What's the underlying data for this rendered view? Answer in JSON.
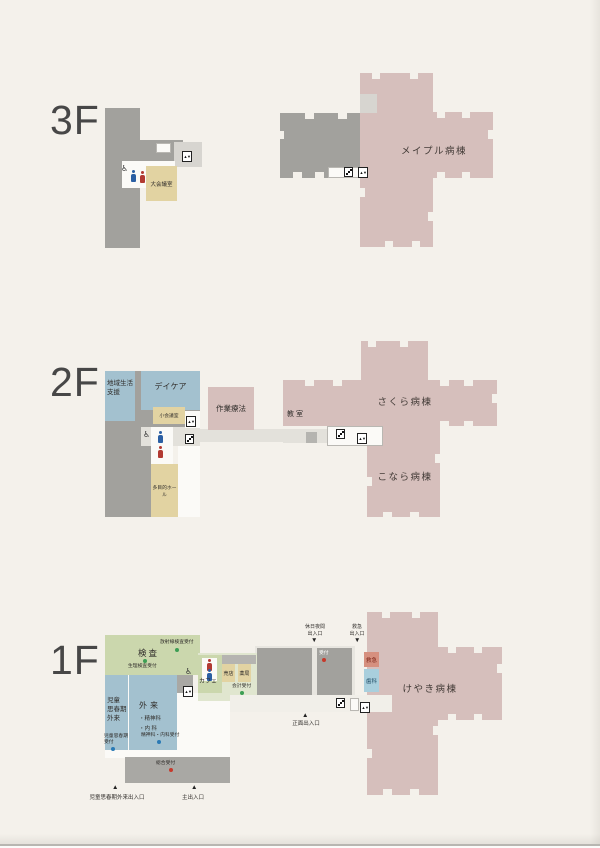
{
  "colors": {
    "background": "#f4f1eb",
    "building_gray": "#a2a19d",
    "building_gray_light": "#d7d5d0",
    "corridor_gray": "#e3e1db",
    "white_room": "#fbfaf7",
    "ward_pink": "#d6bfbc",
    "room_blue": "#a3c1cf",
    "room_green": "#cbd7ad",
    "room_green_pale": "#e0e6cf",
    "room_tan": "#e2d3a2",
    "emergency_salmon": "#d6907f",
    "dental_blue": "#a9cfdd",
    "plaza_gray": "#e8e6e0",
    "text_dark": "#322f2c",
    "dot_green": "#3d9e54",
    "dot_red": "#c6392b",
    "dot_blue": "#2a7ab5",
    "toilet_male_blue": "#2b5fa3",
    "toilet_female_red": "#b23a32"
  },
  "icons": {
    "elevator": "▲▼",
    "wheelchair": "♿",
    "triangle_up": "▲",
    "triangle_down": "▼"
  },
  "f3": {
    "label": "3F",
    "large_meeting_room": "大会議室",
    "ward_maple": "メイプル病棟"
  },
  "f2": {
    "label": "2F",
    "community_support_l1": "地域生活",
    "community_support_l2": "支援",
    "daycare": "デイケア",
    "small_meeting_room": "小会議室",
    "multipurpose_hall": "多目的ホール",
    "occupational_therapy": "作業療法",
    "classroom": "教室",
    "ward_sakura": "さくら病棟",
    "ward_konara": "こなら病棟"
  },
  "f1": {
    "label": "1F",
    "examination": "検査",
    "radiology_reception": "放射線検査受付",
    "physiology_reception": "生理検査受付",
    "cafe": "カフェ",
    "shop": "売店",
    "pharmacy": "薬局",
    "cashier_reception": "会計受付",
    "child_adolescent_outpatient_l1": "児童",
    "child_adolescent_outpatient_l2": "思春期",
    "child_adolescent_outpatient_l3": "外来",
    "outpatient": "外来",
    "outpatient_psychiatry": "・精神科",
    "outpatient_internal": "・内 科",
    "child_adolescent_reception_l1": "児童思春期",
    "child_adolescent_reception_l2": "受付",
    "psych_internal_reception": "精神科・内科受付",
    "general_reception": "総合受付",
    "reception": "受付",
    "emergency": "救急",
    "dental": "歯科",
    "ward_keyaki": "けやき病棟",
    "holiday_night_entrance_l1": "休日夜間",
    "holiday_night_entrance_l2": "出入口",
    "emergency_entrance_l1": "救急",
    "emergency_entrance_l2": "出入口",
    "front_entrance": "正面出入口",
    "child_adolescent_entrance": "児童思春期外来出入口",
    "main_entrance": "主出入口"
  }
}
